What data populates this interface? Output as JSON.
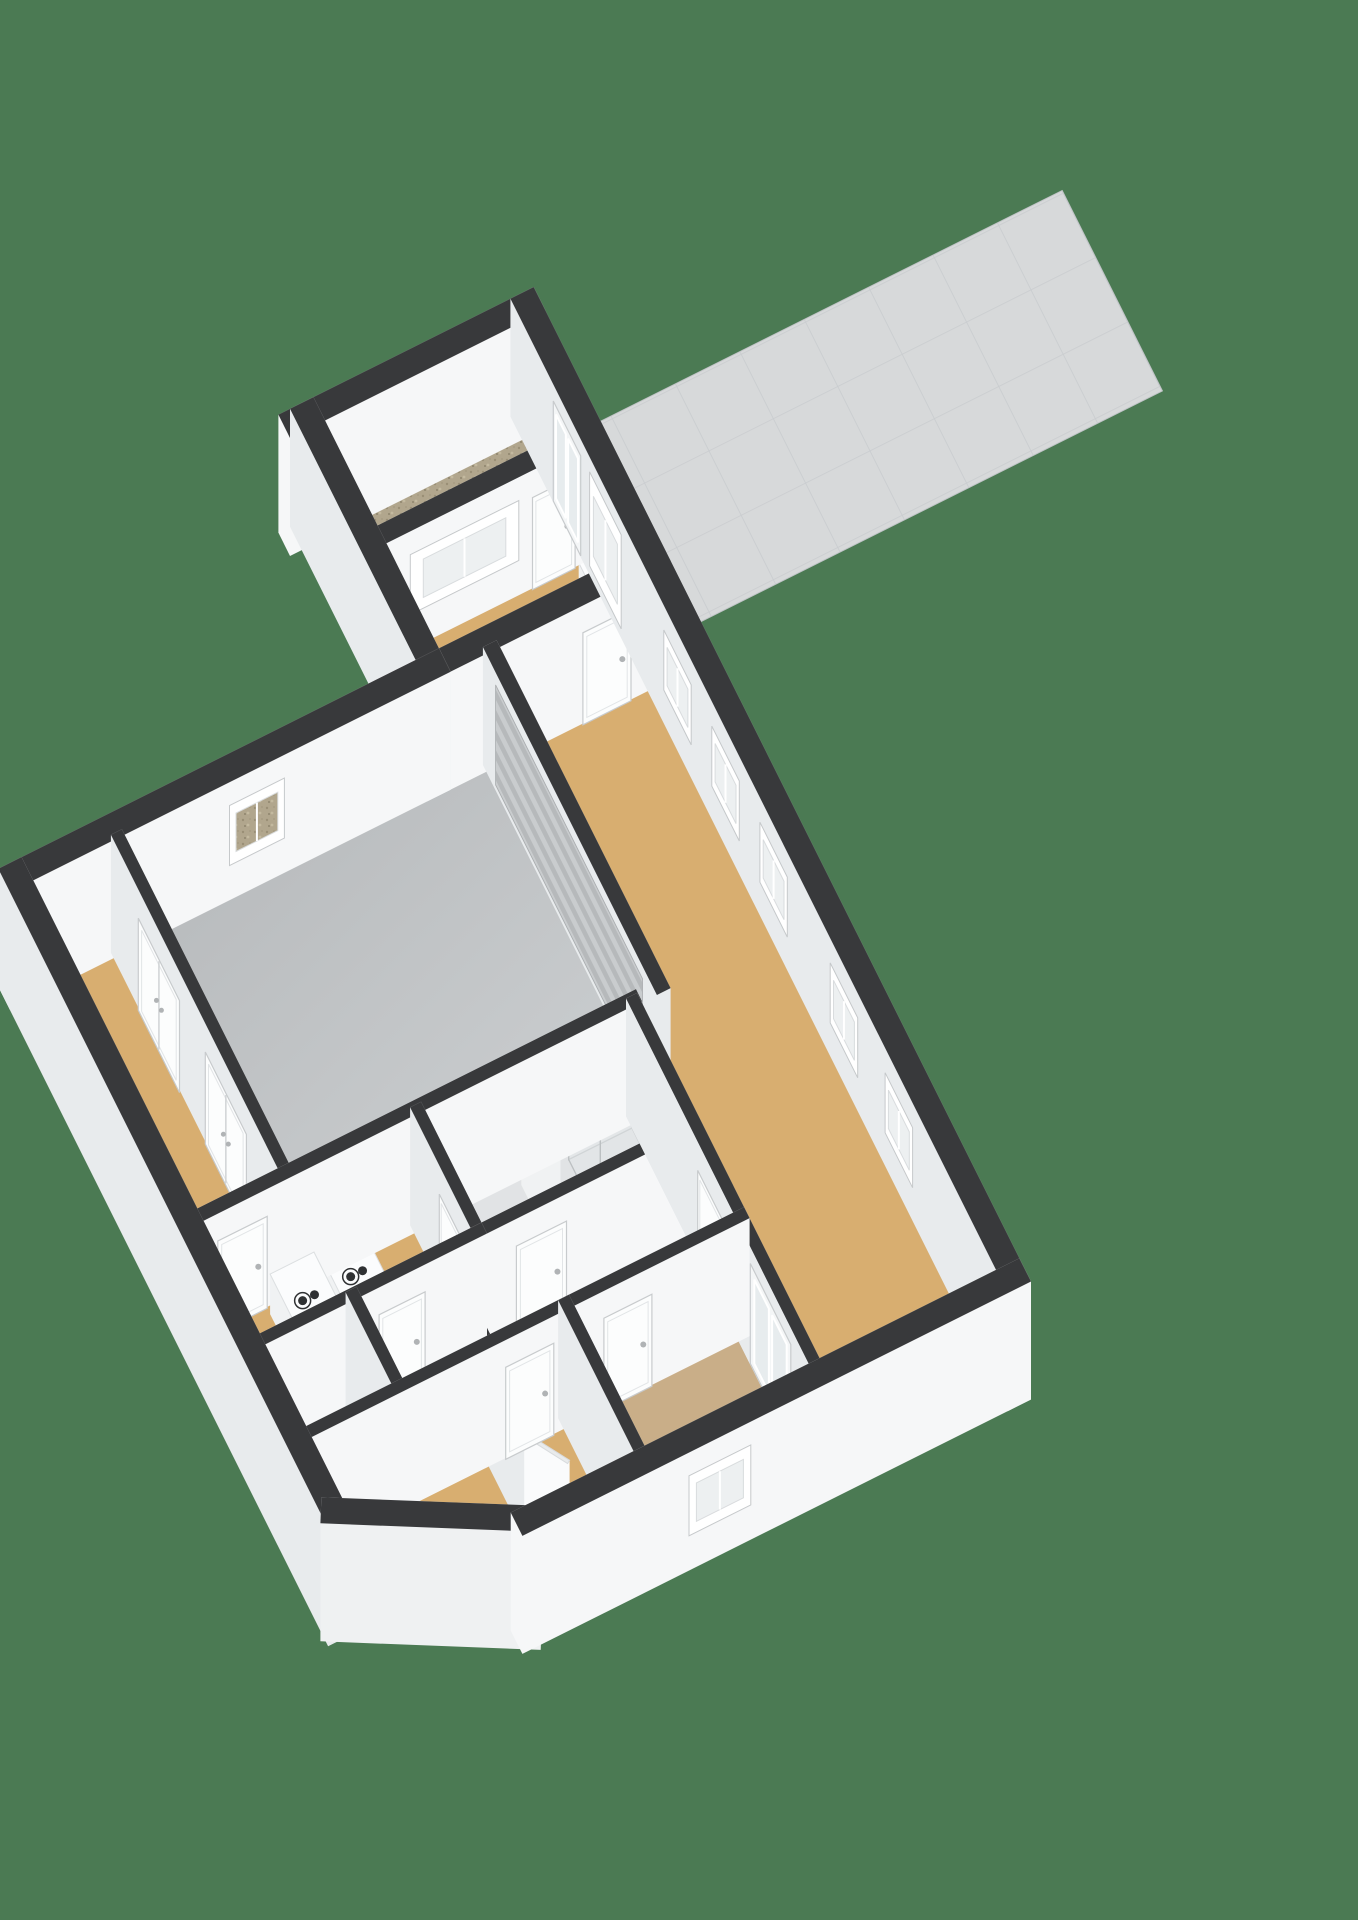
{
  "scene": {
    "title": "3d-floorplan-isometric-render",
    "background": "#4b7a53",
    "colors": {
      "wall_cap": "#38393b",
      "wall_face_ew": "#f6f7f8",
      "wall_face_ns": "#e8ebed",
      "wall_face_chamfer": "#eff1f2",
      "floor_tan": "#d8ae70",
      "floor_tan_muted": "#c9ae88",
      "floor_garage": "url(#gfloor)",
      "floor_bath": "#e1e3e5",
      "floor_gravel": "url(#gravel)",
      "patio_fill": "url(#tile)",
      "door_fill": "#fcfdfd",
      "door_frame": "#c8cbcd",
      "glass_fill": "#e7ecee",
      "window_fill": "#edf0f1",
      "roller_fill": "url(#roller)",
      "fixture_face": "#f0f2f3",
      "fixture_top": "#fbfcfd",
      "knob_dark": "#2f3133"
    },
    "projection": {
      "east": [
        0.88,
        -0.44
      ],
      "south": [
        0.44,
        0.88
      ],
      "scale": 78,
      "origin": [
        150,
        940
      ],
      "wall_lift": 118,
      "door_lift": 92,
      "window_lift": [
        36,
        96
      ],
      "tall_window_lift": [
        12,
        106
      ],
      "roller_lift": [
        8,
        108
      ],
      "glassdoor_lift": [
        4,
        104
      ]
    },
    "patio": {
      "id": "patio",
      "poly": [
        [
          7.56,
          -3.42
        ],
        [
          15.0,
          -3.42
        ],
        [
          15.0,
          -0.5
        ],
        [
          7.56,
          -0.5
        ]
      ]
    },
    "rooms": [
      {
        "id": "storage",
        "fill": "floor_gravel",
        "poly": [
          [
            4.36,
            -3.68
          ],
          [
            7.28,
            -3.68
          ],
          [
            7.28,
            -2.1
          ],
          [
            4.36,
            -2.1
          ]
        ]
      },
      {
        "id": "entry-hall",
        "fill": "floor_tan",
        "poly": [
          [
            4.36,
            -1.9
          ],
          [
            7.28,
            -1.9
          ],
          [
            7.28,
            -0.12
          ],
          [
            4.36,
            -0.12
          ]
        ]
      },
      {
        "id": "corridor",
        "fill": "floor_tan",
        "poly": [
          [
            -1.72,
            -0.05
          ],
          [
            -0.5,
            -0.05
          ],
          [
            -0.5,
            4.8
          ],
          [
            -1.72,
            4.8
          ]
        ]
      },
      {
        "id": "garage",
        "fill": "floor_garage",
        "poly": [
          [
            -0.4,
            -0.05
          ],
          [
            4.95,
            -0.05
          ],
          [
            4.95,
            4.82
          ],
          [
            -0.4,
            4.82
          ]
        ]
      },
      {
        "id": "living-room",
        "fill": "floor_tan",
        "poly": [
          [
            5.05,
            -0.05
          ],
          [
            7.3,
            -0.05
          ],
          [
            7.3,
            10.2
          ],
          [
            4.65,
            10.2
          ],
          [
            4.65,
            4.95
          ],
          [
            5.05,
            4.95
          ]
        ]
      },
      {
        "id": "utility-room",
        "fill": "floor_tan",
        "poly": [
          [
            -1.72,
            4.92
          ],
          [
            1.42,
            4.92
          ],
          [
            1.42,
            6.64
          ],
          [
            -1.72,
            6.64
          ]
        ]
      },
      {
        "id": "bathroom",
        "fill": "floor_bath",
        "poly": [
          [
            1.5,
            4.92
          ],
          [
            4.56,
            4.92
          ],
          [
            4.56,
            6.64
          ],
          [
            1.5,
            6.64
          ]
        ]
      },
      {
        "id": "boiler-closet",
        "fill": "floor_tan",
        "poly": [
          [
            -0.34,
            6.74
          ],
          [
            0.86,
            6.74
          ],
          [
            0.86,
            8.0
          ],
          [
            -0.34,
            8.0
          ]
        ]
      },
      {
        "id": "hallway",
        "fill": "floor_tan",
        "poly": [
          [
            0.94,
            6.72
          ],
          [
            4.56,
            6.72
          ],
          [
            4.56,
            8.0
          ],
          [
            0.94,
            8.0
          ]
        ]
      },
      {
        "id": "bedroom",
        "fill": "floor_tan",
        "poly": [
          [
            -1.72,
            8.07
          ],
          [
            2.0,
            8.07
          ],
          [
            2.0,
            10.2
          ],
          [
            0.44,
            10.2
          ],
          [
            -1.72,
            8.98
          ]
        ]
      },
      {
        "id": "south-room",
        "fill": "floor_tan_muted",
        "poly": [
          [
            2.1,
            8.07
          ],
          [
            4.56,
            8.07
          ],
          [
            4.56,
            10.2
          ],
          [
            2.1,
            10.2
          ]
        ]
      }
    ],
    "walls": [
      {
        "id": "ext-north",
        "line": [
          -1.87,
          -0.17,
          4.21,
          -0.17
        ],
        "th": 0.34,
        "ops": [
          {
            "k": "gravelwin",
            "a": [
              1.15,
              -0.17
            ],
            "b": [
              1.95,
              -0.17
            ]
          }
        ]
      },
      {
        "id": "ext-north-east",
        "line": [
          4.21,
          -0.17,
          7.42,
          -0.17
        ],
        "th": 0.34,
        "ops": [
          {
            "k": "door",
            "a": [
              6.3,
              -0.17
            ],
            "b": [
              7.0,
              -0.17
            ]
          }
        ]
      },
      {
        "id": "ext-annex-west",
        "line": [
          4.21,
          -0.17,
          4.21,
          -3.83
        ],
        "th": 0.34,
        "ops": []
      },
      {
        "id": "ext-annex-north",
        "line": [
          4.04,
          -3.83,
          7.42,
          -3.83
        ],
        "th": 0.34,
        "ops": []
      },
      {
        "id": "ext-east",
        "line": [
          7.42,
          -3.83,
          7.42,
          10.32
        ],
        "th": 0.34,
        "ops": [
          {
            "k": "gdoor",
            "a": [
              7.42,
              -2.72
            ],
            "b": [
              7.42,
              -1.92
            ]
          },
          {
            "k": "twindow",
            "a": [
              7.42,
              -1.66
            ],
            "b": [
              7.42,
              -0.74
            ]
          },
          {
            "k": "window",
            "a": [
              7.42,
              0.5
            ],
            "b": [
              7.42,
              1.3
            ]
          },
          {
            "k": "window",
            "a": [
              7.42,
              1.9
            ],
            "b": [
              7.42,
              2.7
            ]
          },
          {
            "k": "window",
            "a": [
              7.42,
              3.3
            ],
            "b": [
              7.42,
              4.1
            ]
          },
          {
            "k": "window",
            "a": [
              7.42,
              5.35
            ],
            "b": [
              7.42,
              6.15
            ]
          },
          {
            "k": "window",
            "a": [
              7.42,
              6.95
            ],
            "b": [
              7.42,
              7.75
            ]
          }
        ]
      },
      {
        "id": "ext-south",
        "line": [
          7.42,
          10.32,
          0.35,
          10.32
        ],
        "th": 0.34,
        "ops": [
          {
            "k": "window",
            "a": [
              3.5,
              10.32
            ],
            "b": [
              2.6,
              10.32
            ]
          }
        ]
      },
      {
        "id": "ext-chamfer",
        "line": [
          0.35,
          10.32,
          -1.87,
          9.1
        ],
        "th": 0.34,
        "ops": []
      },
      {
        "id": "ext-west",
        "line": [
          -1.87,
          9.1,
          -1.87,
          -0.17
        ],
        "th": 0.34,
        "ops": []
      },
      {
        "id": "int-storage-south",
        "line": [
          4.38,
          -2.0,
          7.25,
          -2.0
        ],
        "th": 0.26,
        "ops": [
          {
            "k": "window",
            "a": [
              4.72,
              -2.0
            ],
            "b": [
              6.3,
              -2.0
            ]
          },
          {
            "k": "door",
            "a": [
              6.5,
              -2.0
            ],
            "b": [
              7.12,
              -2.0
            ]
          }
        ]
      },
      {
        "id": "int-corridor-east",
        "line": [
          -0.45,
          0.0,
          -0.45,
          4.75
        ],
        "th": 0.16,
        "ops": [
          {
            "k": "ddoor",
            "a": [
              -0.45,
              0.75
            ],
            "b": [
              -0.45,
              1.95
            ]
          },
          {
            "k": "ddoor",
            "a": [
              -0.45,
              2.7
            ],
            "b": [
              -0.45,
              3.9
            ]
          }
        ]
      },
      {
        "id": "int-mid",
        "line": [
          -1.87,
          4.87,
          4.6,
          4.87
        ],
        "th": 0.18,
        "ops": [
          {
            "k": "door",
            "a": [
              -1.5,
              4.87
            ],
            "b": [
              -0.78,
              4.87
            ]
          }
        ]
      },
      {
        "id": "int-garage-east",
        "line": [
          5.0,
          0.0,
          5.0,
          4.87
        ],
        "th": 0.2,
        "ops": [
          {
            "k": "roller",
            "a": [
              5.0,
              0.3
            ],
            "b": [
              5.0,
              4.58
            ]
          }
        ]
      },
      {
        "id": "int-bath-west",
        "line": [
          1.45,
          4.92,
          1.45,
          6.64
        ],
        "th": 0.16,
        "ops": [
          {
            "k": "door",
            "a": [
              1.45,
              5.72
            ],
            "b": [
              1.45,
              6.42
            ]
          }
        ]
      },
      {
        "id": "int-bath-south",
        "line": [
          1.45,
          6.68,
          4.6,
          6.68
        ],
        "th": 0.16,
        "ops": [
          {
            "k": "door",
            "a": [
              1.95,
              6.68
            ],
            "b": [
              2.68,
              6.68
            ]
          }
        ]
      },
      {
        "id": "int-living-west",
        "line": [
          4.6,
          4.91,
          4.6,
          10.2
        ],
        "th": 0.16,
        "ops": [
          {
            "k": "door",
            "a": [
              4.6,
              6.95
            ],
            "b": [
              4.6,
              7.68
            ]
          },
          {
            "k": "gdoor",
            "a": [
              4.6,
              8.48
            ],
            "b": [
              4.6,
              9.66
            ]
          }
        ]
      },
      {
        "id": "int-closet-east",
        "line": [
          0.9,
          6.68,
          0.9,
          8.03
        ],
        "th": 0.16,
        "ops": []
      },
      {
        "id": "int-closet-west",
        "line": [
          -0.38,
          6.7,
          -0.38,
          8.03
        ],
        "th": 0.16,
        "ops": []
      },
      {
        "id": "int-utility-south",
        "line": [
          -1.87,
          6.68,
          1.45,
          6.68
        ],
        "th": 0.16,
        "ops": [
          {
            "k": "door",
            "a": [
              -0.05,
              6.68
            ],
            "b": [
              0.62,
              6.68
            ]
          }
        ]
      },
      {
        "id": "int-bedrooms-north",
        "line": [
          -1.87,
          8.03,
          4.6,
          8.03
        ],
        "th": 0.16,
        "ops": [
          {
            "k": "door",
            "a": [
              1.12,
              8.03
            ],
            "b": [
              1.82,
              8.03
            ]
          },
          {
            "k": "door",
            "a": [
              2.55,
              8.03
            ],
            "b": [
              3.25,
              8.03
            ]
          }
        ]
      },
      {
        "id": "int-divider",
        "line": [
          2.05,
          8.03,
          2.05,
          10.32
        ],
        "th": 0.16,
        "ops": []
      },
      {
        "id": "int-closet-stub",
        "line": [
          0.95,
          8.03,
          0.95,
          8.98
        ],
        "th": 0.14,
        "ops": []
      },
      {
        "id": "door-leaf-open",
        "line": [
          0.98,
          9.02,
          1.3,
          9.55
        ],
        "th": 0.05,
        "ops": [],
        "panel": true
      }
    ],
    "fixtures": [
      {
        "type": "washer",
        "id": "washing-machine",
        "rect": [
          -0.78,
          5.06,
          0.64,
          0.64
        ]
      },
      {
        "type": "washer",
        "id": "dryer",
        "rect": [
          -0.08,
          5.06,
          0.64,
          0.64
        ]
      },
      {
        "type": "boiler",
        "id": "boiler-unit",
        "rect": [
          0.04,
          6.95,
          0.5,
          0.42
        ]
      },
      {
        "type": "shower",
        "id": "shower-cabin",
        "rect": [
          3.6,
          5.0,
          0.92,
          0.92
        ]
      },
      {
        "type": "toilet",
        "id": "toilet",
        "rect": [
          2.9,
          5.02,
          0.46,
          0.6
        ]
      },
      {
        "type": "radiator",
        "id": "radiator",
        "rect": [
          7.02,
          -1.55,
          0.2,
          0.8
        ]
      }
    ]
  }
}
